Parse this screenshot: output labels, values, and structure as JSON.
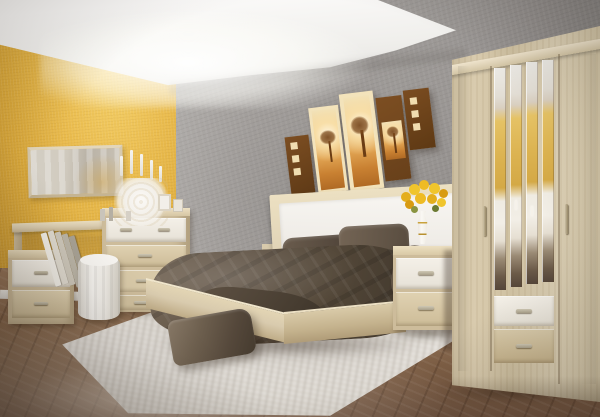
{
  "meta": {
    "width": 600,
    "height": 417,
    "scene_type": "bedroom interior photograph"
  },
  "palette": {
    "wall-yellow": "#ebbd4f",
    "wall-yellow-deep": "#cd9a31",
    "wall-gray": "#989491",
    "ceiling": "#fbfaf9",
    "wood-light": "#d9cbae",
    "wood-mid": "#cdbc9b",
    "trim-white": "#e6e1d6",
    "bedding": "#544839",
    "bedding-dark": "#3a3127",
    "floor": "#8a6a4e",
    "floor-dark": "#6f5340",
    "rug": "#eae6e0",
    "art-brown": "#7c4e22",
    "art-cream": "#f3e3bb",
    "art-orange": "#e0a352",
    "flower-yellow": "#eebb25",
    "metal": "#a9a08a",
    "mirror-yellow": "#e5c265"
  },
  "scene": {
    "elements": [
      "yellow accent wall",
      "gray textured back wall",
      "white ceiling with cove lighting",
      "five-panel savanna wall art",
      "horizontal wall mirror",
      "vanity desk",
      "four-drawer commode",
      "two-drawer nightstand left",
      "white pouf",
      "white openwork candelabra with candles",
      "leaning books",
      "mini picture frames",
      "double bed with white upholstered headboard",
      "dark satin duvet",
      "two dark pillows",
      "white bedside lamp",
      "small photo frame",
      "two-drawer nightstand right",
      "white vase with yellow roses",
      "four-door mirrored wardrobe with two drawers",
      "white shaggy rug",
      "dark cushion on rug",
      "diagonal wooden plank floor"
    ]
  }
}
